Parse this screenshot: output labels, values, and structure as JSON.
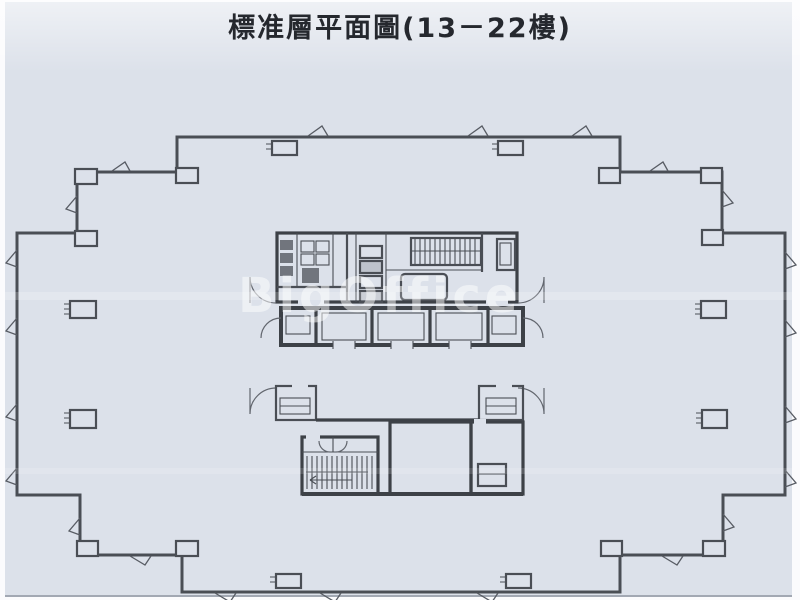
{
  "page": {
    "title": "標准層平面圖(13－22樓)",
    "watermark": "BigOffice"
  },
  "colors": {
    "paper": "#dce1ea",
    "ink": "#4a4e55",
    "wall": "#3d4147",
    "title": "#25282e",
    "wm": "#ffffff"
  }
}
